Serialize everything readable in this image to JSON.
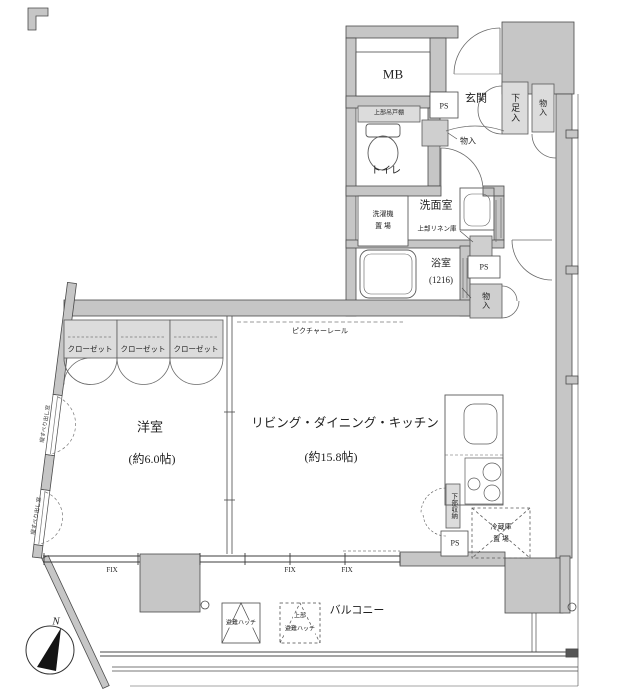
{
  "plan": {
    "title": "apartment-floor-plan",
    "rooms": {
      "mb": "MB",
      "entrance": "玄関",
      "shoe_cabinet": "下足入",
      "storage_entrance": "物入",
      "ps_top": "PS",
      "upper_cupboard": "上部吊戸棚",
      "toilet": "トイレ",
      "storage_hall": "物入",
      "washroom": "洗面室",
      "washer_line1": "洗濯機",
      "washer_line2": "置 場",
      "linen": "上部リネン庫",
      "bath": "浴室",
      "bath_size": "(1216)",
      "ps_mid": "PS",
      "storage_mid": "物入",
      "closet": "クローゼット",
      "picture_rail": "ピクチャーレール",
      "western_room": "洋室",
      "western_room_size": "(約6.0帖)",
      "ldk": "リビング・ダイニング・キッチン",
      "ldk_size": "(約15.8帖)",
      "lower_storage": "下部収納",
      "fridge_line1": "冷蔵庫",
      "fridge_line2": "置 場",
      "ps_bottom": "PS",
      "fix": "FIX",
      "balcony": "バルコニー",
      "hatch": "避難ハッチ",
      "hatch_upper_line1": "上部",
      "hatch_upper_line2": "避難ハッチ",
      "window_note": "縦すべり出し窓",
      "north": "N"
    },
    "colors": {
      "wall": "#c6c6c6",
      "fixture": "#dcdcdc",
      "line": "#4a4a4a"
    }
  }
}
